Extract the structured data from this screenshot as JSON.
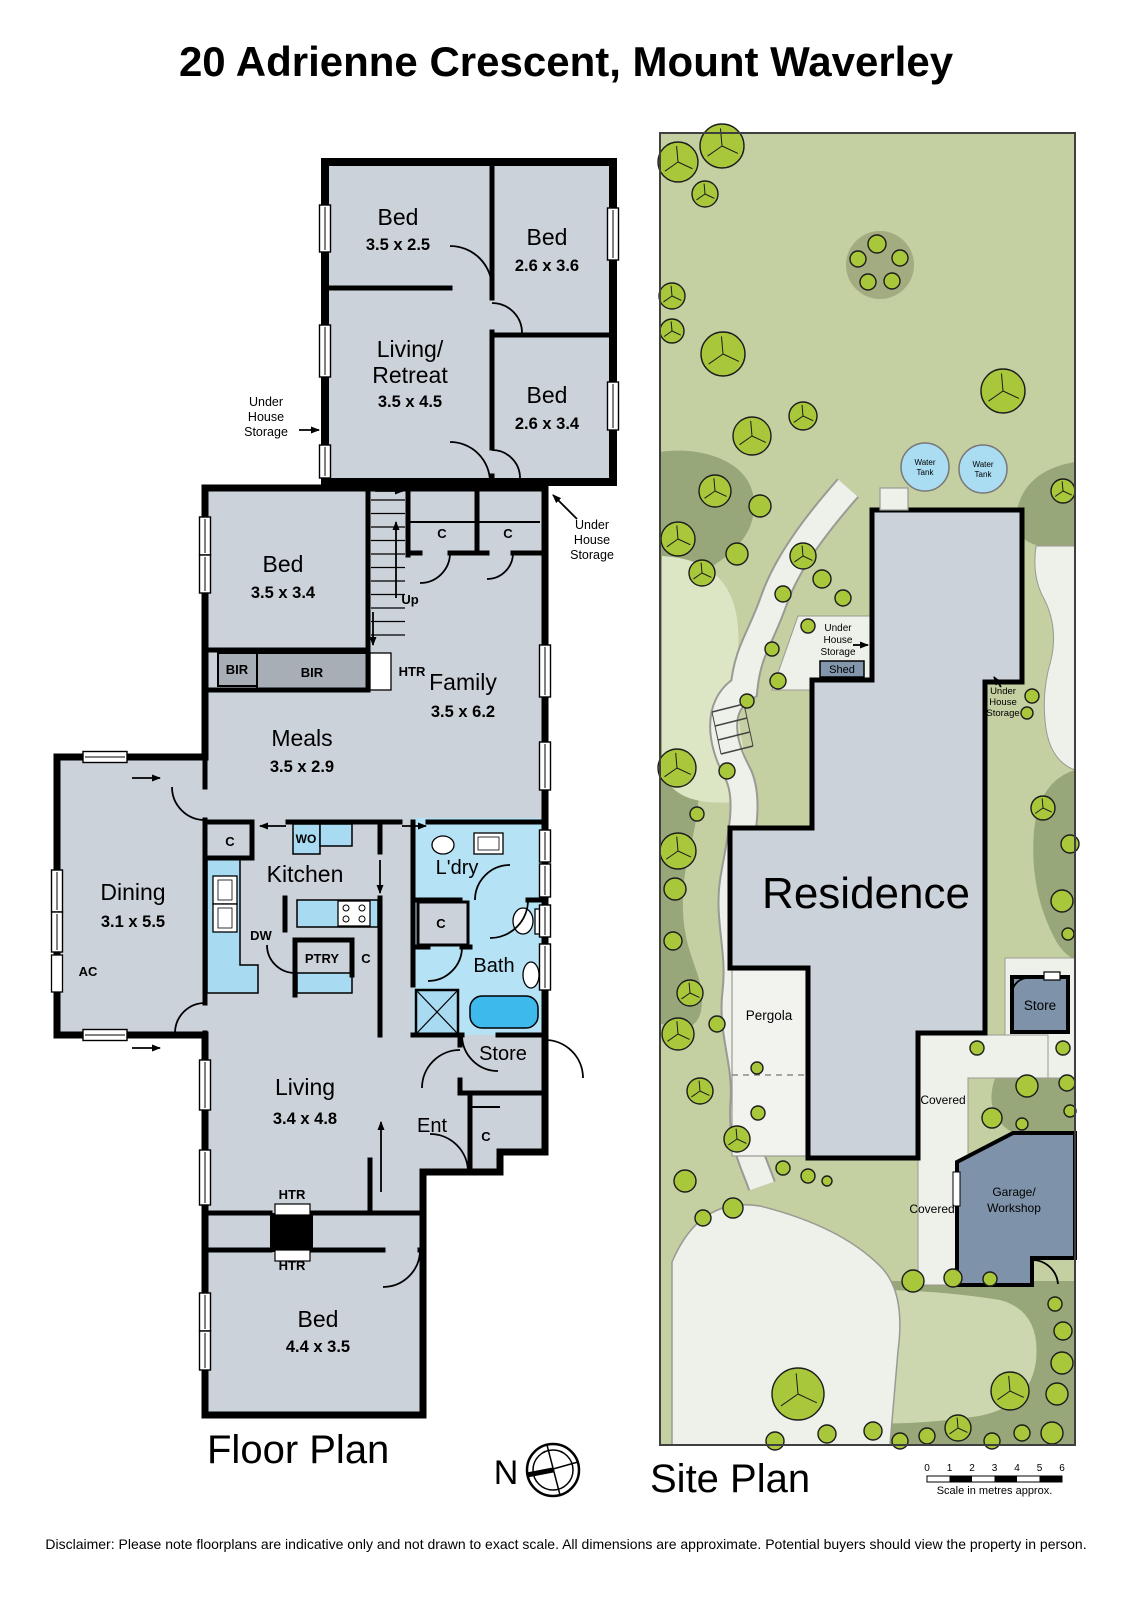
{
  "title": "20 Adrienne Crescent, Mount Waverley",
  "floor_plan": {
    "caption": "Floor Plan",
    "rooms": {
      "bed_top1": {
        "name": "Bed",
        "dims": "3.5 x 2.5"
      },
      "bed_top2": {
        "name": "Bed",
        "dims": "2.6 x 3.6"
      },
      "living_retreat": {
        "line1": "Living/",
        "line2": "Retreat",
        "dims": "3.5 x 4.5"
      },
      "bed_top3": {
        "name": "Bed",
        "dims": "2.6 x 3.4"
      },
      "bed_mid": {
        "name": "Bed",
        "dims": "3.5 x 3.4"
      },
      "family": {
        "name": "Family",
        "dims": "3.5 x 6.2"
      },
      "meals": {
        "name": "Meals",
        "dims": "3.5 x 2.9"
      },
      "dining": {
        "name": "Dining",
        "dims": "3.1 x 5.5"
      },
      "kitchen": {
        "name": "Kitchen"
      },
      "laundry": {
        "name": "L'dry"
      },
      "bath": {
        "name": "Bath"
      },
      "living": {
        "name": "Living",
        "dims": "3.4 x 4.8"
      },
      "entry": {
        "name": "Ent"
      },
      "store": {
        "name": "Store"
      },
      "bed_lower": {
        "name": "Bed",
        "dims": "4.4 x 3.5"
      }
    },
    "fixtures": {
      "bir": "BIR",
      "htr": "HTR",
      "wo": "WO",
      "dw": "DW",
      "ptry": "PTRY",
      "ac": "AC",
      "c": "C",
      "up": "Up"
    },
    "annotations": {
      "under": "Under",
      "house": "House",
      "storage": "Storage"
    }
  },
  "site_plan": {
    "caption": "Site Plan",
    "labels": {
      "residence": "Residence",
      "pergola": "Pergola",
      "covered": "Covered",
      "garage_line1": "Garage/",
      "garage_line2": "Workshop",
      "store": "Store",
      "shed": "Shed",
      "water": "Water",
      "tank": "Tank"
    },
    "scale_bar": {
      "ticks": [
        "0",
        "1",
        "2",
        "3",
        "4",
        "5",
        "6"
      ],
      "caption": "Scale in metres approx."
    }
  },
  "compass": {
    "north": "N"
  },
  "footer": {
    "disclaimer": "Disclaimer: Please note floorplans are indicative only and not drawn to exact scale. All dimensions are approximate. Potential buyers should view the property in person."
  },
  "colors": {
    "floor": "#ccd2da",
    "wet_room": "#b5e2f4",
    "fixture_blue": "#a8daf2",
    "tub_blue": "#3db9eb",
    "robe_gray": "#a8aeb6",
    "lawn": "#c4cfa2",
    "garden_dark": "#98a779",
    "lawn_pale": "#dce6c4",
    "path_white": "#eef0ea",
    "building_gray": "#ccd2da",
    "outbuilding": "#7e93a9",
    "tree": "#a9c73b",
    "tank": "#aadcf2"
  }
}
